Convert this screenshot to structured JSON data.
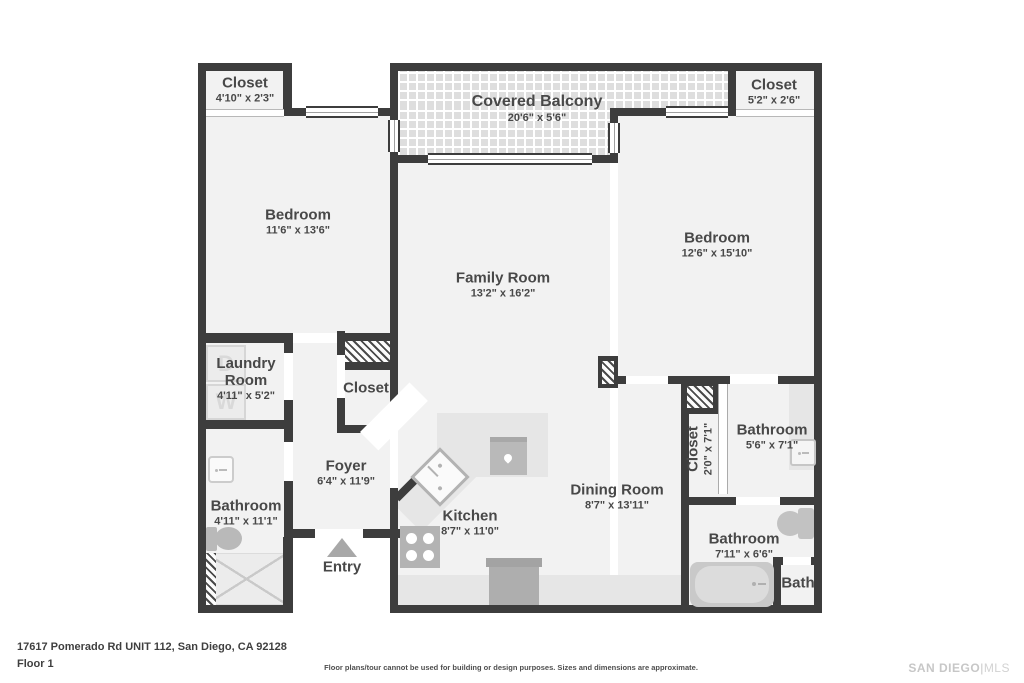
{
  "rooms": {
    "closet_tl": {
      "name": "Closet",
      "dims": "4'10\" x 2'3\""
    },
    "balcony": {
      "name": "Covered Balcony",
      "dims": "20'6\" x 5'6\""
    },
    "closet_tr": {
      "name": "Closet",
      "dims": "5'2\" x 2'6\""
    },
    "bedroom_left": {
      "name": "Bedroom",
      "dims": "11'6\" x 13'6\""
    },
    "bedroom_right": {
      "name": "Bedroom",
      "dims": "12'6\" x 15'10\""
    },
    "family_room": {
      "name": "Family Room",
      "dims": "13'2\" x 16'2\""
    },
    "laundry": {
      "name": "Laundry Room",
      "dims": "4'11\" x 5'2\""
    },
    "closet_center": {
      "name": "Closet"
    },
    "foyer": {
      "name": "Foyer",
      "dims": "6'4\" x 11'9\""
    },
    "bathroom_left": {
      "name": "Bathroom",
      "dims": "4'11\" x 11'1\""
    },
    "kitchen": {
      "name": "Kitchen",
      "dims": "8'7\" x 11'0\""
    },
    "dining": {
      "name": "Dining Room",
      "dims": "8'7\" x 13'11\""
    },
    "closet_right": {
      "name": "Closet",
      "dims": "2'0\" x 7'1\""
    },
    "bathroom_mid_right": {
      "name": "Bathroom",
      "dims": "5'6\" x 7'1\""
    },
    "bathroom_bottom_right": {
      "name": "Bathroom",
      "dims": "7'11\" x 6'6\""
    },
    "bath": {
      "name": "Bath"
    },
    "entry": {
      "name": "Entry"
    }
  },
  "laundry_appliances": {
    "dryer_letter": "D",
    "washer_letter": "W"
  },
  "footer": {
    "address": "17617 Pomerado Rd UNIT 112, San Diego, CA 92128",
    "floor_label": "Floor 1",
    "disclaimer": "Floor plans/tour cannot be used for building or design purposes. Sizes and dimensions are approximate.",
    "brand_name": "SAN DIEGO",
    "brand_separator": "|",
    "brand_suffix": "MLS"
  },
  "colors": {
    "wall": "#3d3d3d",
    "floor": "#f2f2f2",
    "fixture_gray": "#b9b9b9",
    "label_text": "#484848"
  }
}
